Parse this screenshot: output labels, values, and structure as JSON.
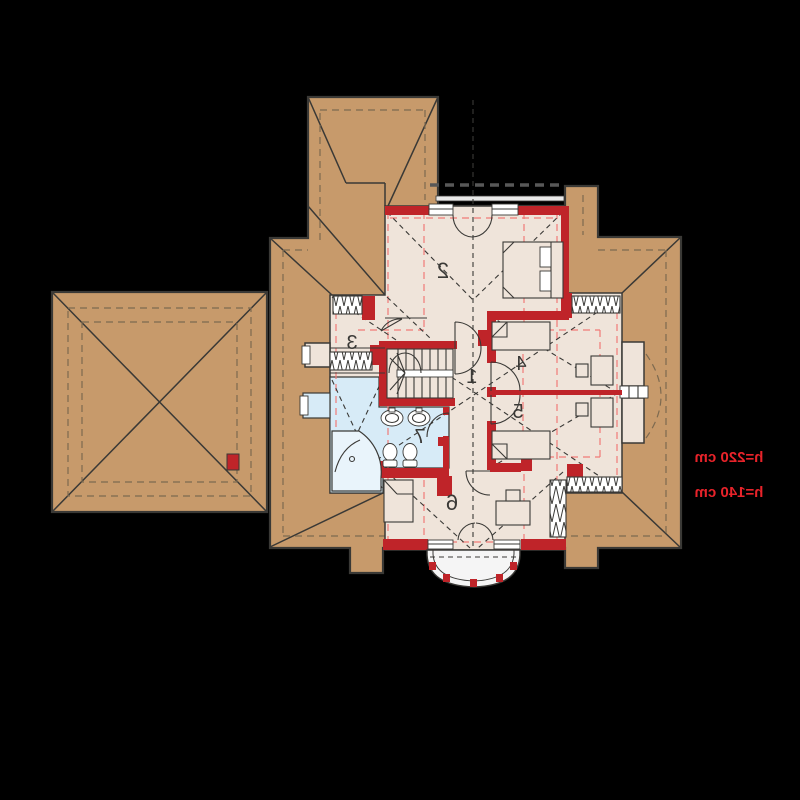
{
  "rooms": {
    "r1": "1",
    "r2": "2",
    "r3": "3",
    "r4": "4",
    "r5": "5",
    "r6": "6",
    "r7": "7"
  },
  "annotations": {
    "h220": "h=220 cm",
    "h140": "h=140 cm"
  },
  "colors": {
    "background": "#000000",
    "roof": "#c79a6b",
    "floor": "#efe4da",
    "bath": "#d7ebf7",
    "wall": "#bf2429",
    "height_line": "#f07a78",
    "annotation": "#e8232a",
    "outline": "#3a3936",
    "eave": "#7d6a50",
    "balcony": "#f5f5f5"
  }
}
